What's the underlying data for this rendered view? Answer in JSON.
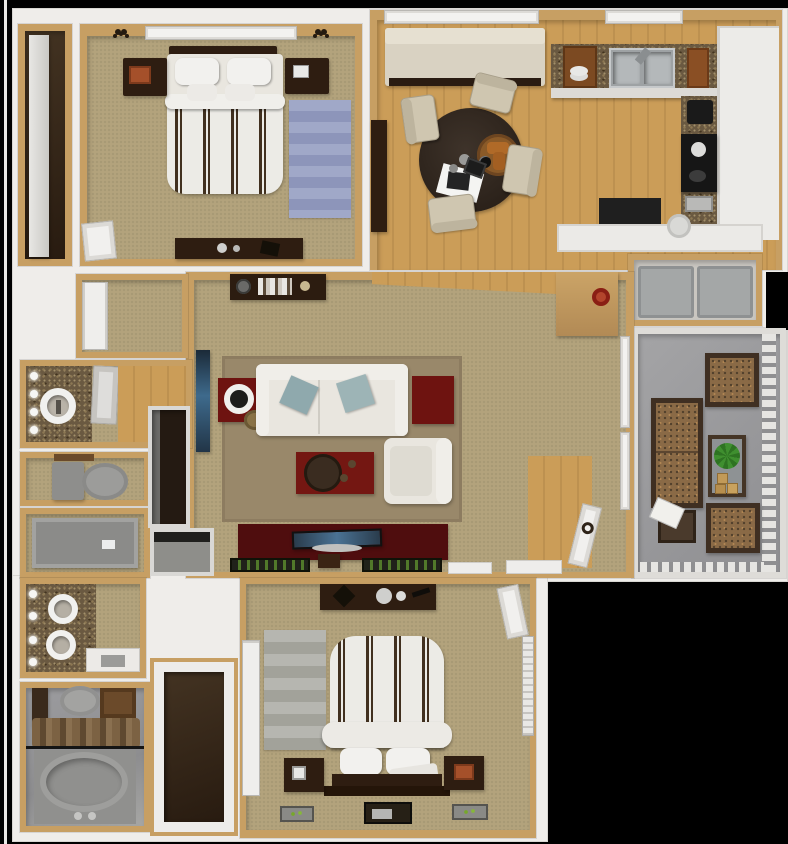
{
  "scene": {
    "type": "floor-plan-3d",
    "description": "Top-down 3D rendering of a two-bedroom two-bathroom apartment floor plan with balcony",
    "background": "#000000"
  },
  "colors": {
    "bg": "#000000",
    "white": "#efedea",
    "wall": "#c79f63",
    "wallLight": "#d8b980",
    "carpet": "#b3a37c",
    "wood": "#bd9150",
    "woodLight": "#cb9d58",
    "granite": "#6a5941",
    "darkwood": "#2e1d11",
    "maroon": "#6e1310",
    "maroonDark": "#4f0d0e",
    "redTable": "#741712",
    "cream": "#e9e6df",
    "creamDark": "#d9d2c2",
    "bluePillow": "#9db4b6",
    "balconyFloor": "#96969a",
    "patioCushion": "#8a6a46",
    "patioFrame": "#3f2f22",
    "plantGreen": "#3f8f2f",
    "applianceGray": "#a4a7a7",
    "fixtureGray": "#8e8e8c",
    "matGreen": "#5d8f2e"
  },
  "rooms": [
    {
      "id": "wardrobe-closet-1",
      "items": [
        "shelf"
      ]
    },
    {
      "id": "bedroom-1",
      "items": [
        "window",
        "wall-sconce-left",
        "wall-sconce-right",
        "headboard",
        "queen-bed-striped-duvet",
        "pillows",
        "nightstand-left",
        "nightstand-right",
        "blue-striped-rug",
        "dresser",
        "closet-door"
      ]
    },
    {
      "id": "dining-area",
      "items": [
        "window",
        "loveseat",
        "console-table",
        "round-dining-table",
        "lazy-susan-with-bread",
        "placemat",
        "dining-chair-x4"
      ]
    },
    {
      "id": "kitchen",
      "items": [
        "window",
        "granite-counter",
        "double-sink",
        "dish-rack",
        "cutting-board",
        "upper-cabinets",
        "range",
        "coffee-maker",
        "toaster",
        "peninsula-cabinets",
        "black-counter",
        "plate"
      ]
    },
    {
      "id": "laundry-closet",
      "items": [
        "washer",
        "dryer"
      ]
    },
    {
      "id": "balcony",
      "items": [
        "outdoor-sofa",
        "outdoor-chair-top",
        "outdoor-chair-bottom",
        "glass-table",
        "potted-plant",
        "crates",
        "side-table",
        "magazine",
        "railing"
      ]
    },
    {
      "id": "living-room",
      "items": [
        "bookshelf",
        "wall-tv",
        "red-end-table-with-lamp",
        "area-rug",
        "sofa",
        "blue-throw-pillows",
        "red-end-table",
        "red-coffee-table",
        "round-tray",
        "armchair",
        "media-console",
        "flat-tv",
        "storage-box",
        "floor-mat-x2",
        "red-wall-decor",
        "window-x2",
        "entry-door",
        "door-wreath",
        "entry-wood-floor",
        "threshold-x2"
      ]
    },
    {
      "id": "hallway",
      "items": [
        "closet-bifold-doors"
      ]
    },
    {
      "id": "bathroom-1",
      "items": [
        "granite-vanity",
        "vessel-sink",
        "vanity-lights",
        "open-door",
        "wood-floor"
      ]
    },
    {
      "id": "water-closet",
      "items": [
        "toilet",
        "shelf"
      ]
    },
    {
      "id": "shower-room",
      "items": [
        "shower-tub",
        "soap-dish"
      ]
    },
    {
      "id": "linen-closet",
      "items": []
    },
    {
      "id": "coat-closet",
      "items": []
    },
    {
      "id": "bathroom-2",
      "items": [
        "granite-vanity",
        "vessel-sink-x2",
        "vanity-lights",
        "shower-stall"
      ]
    },
    {
      "id": "master-bathroom",
      "items": [
        "toilet",
        "dark-cabinet",
        "wood-vanity",
        "towel-rod",
        "towels",
        "garden-tub",
        "tub-faucet"
      ]
    },
    {
      "id": "walk-in-closet",
      "items": []
    },
    {
      "id": "bedroom-2",
      "items": [
        "dresser",
        "mirror-tray",
        "jewelry-box",
        "entry-door",
        "window-blinds",
        "wardrobe-doors",
        "gray-striped-rug",
        "queen-bed-striped-duvet",
        "footboard-bench",
        "pillows",
        "headboard",
        "nightstand-left",
        "nightstand-right",
        "plant-mat-x2",
        "shoe-tray"
      ]
    }
  ]
}
